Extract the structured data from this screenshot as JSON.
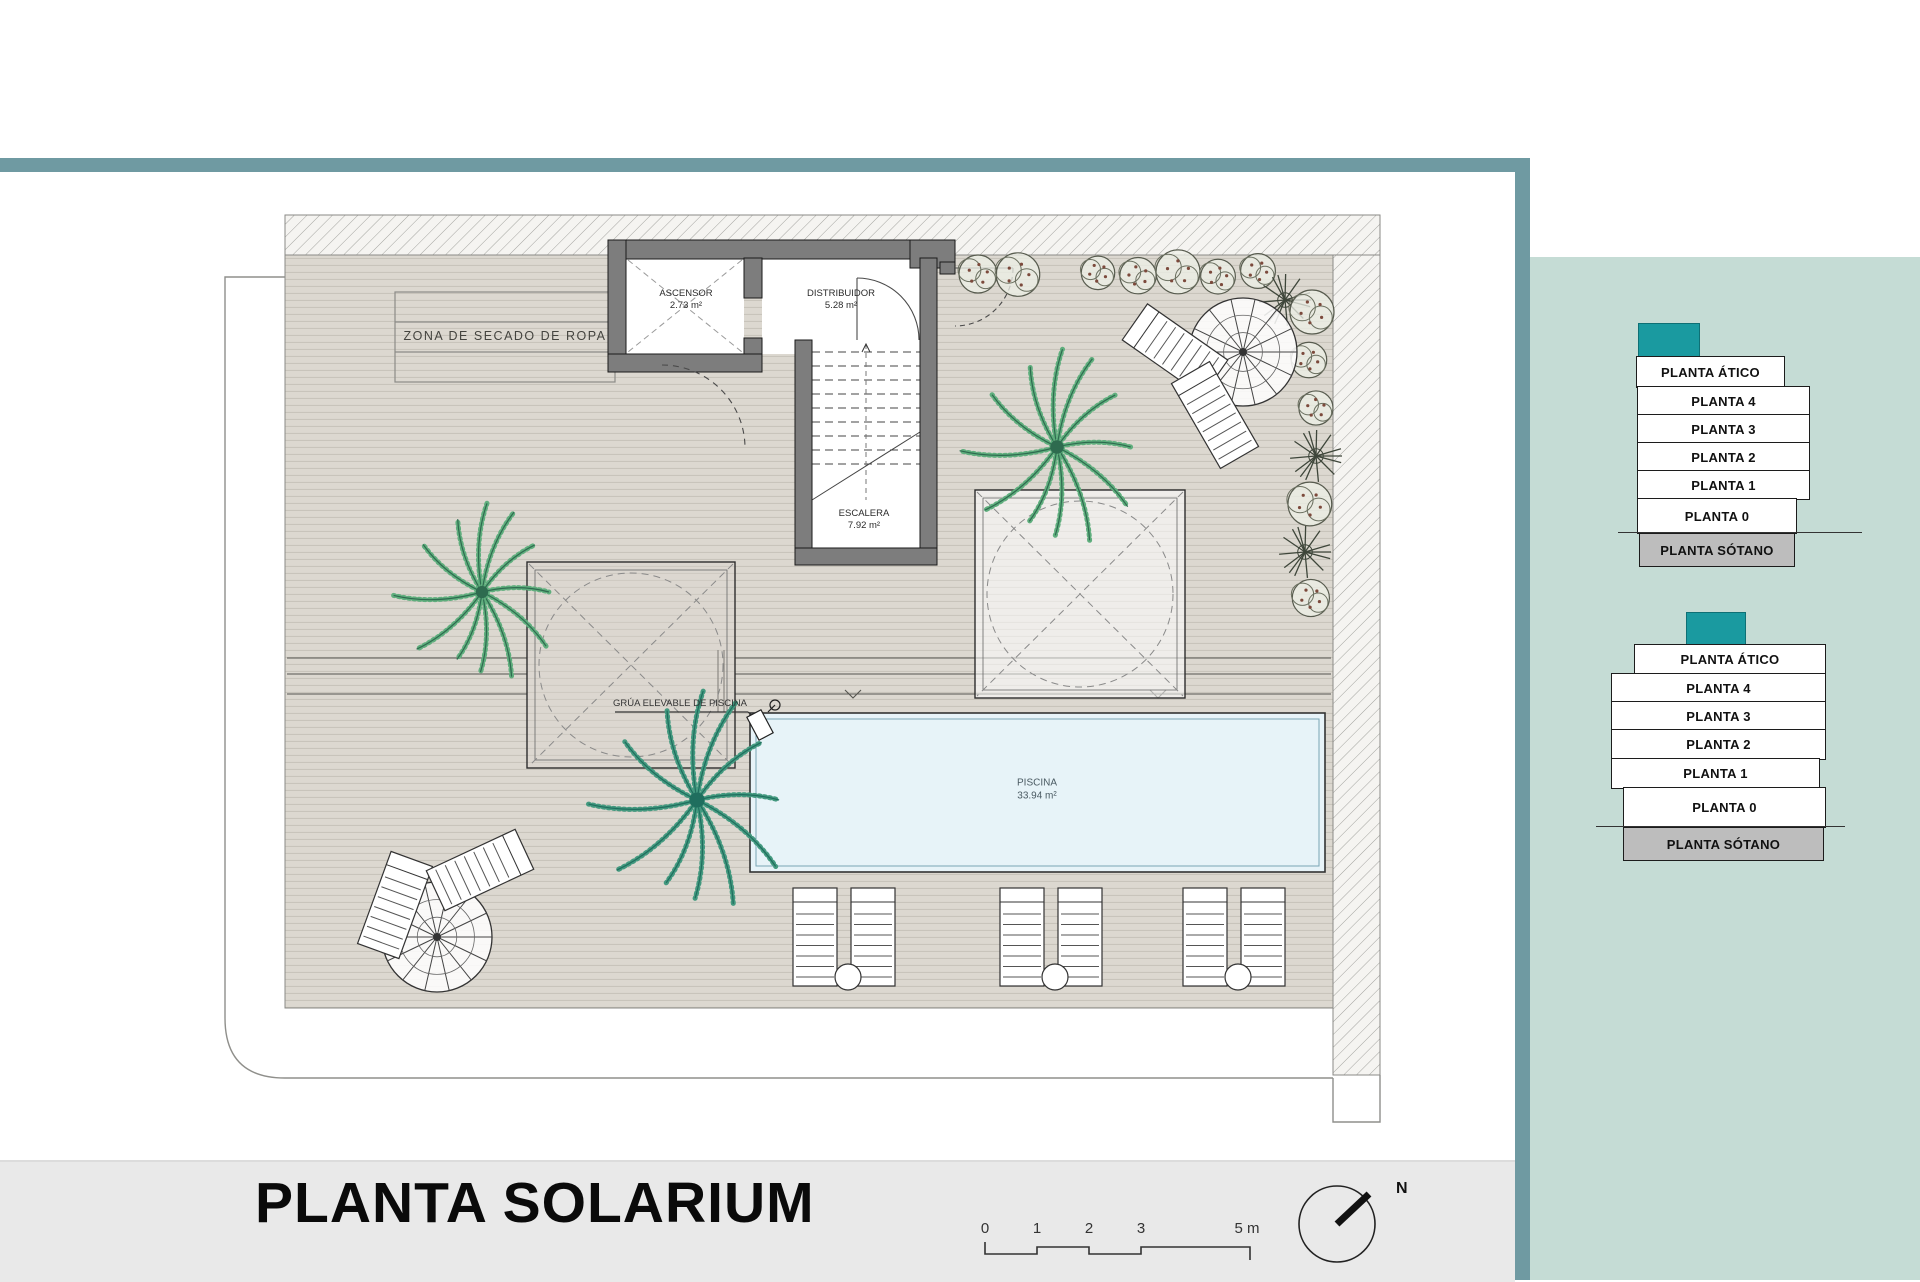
{
  "colors": {
    "accent_teal": "#1a9aa0",
    "frame_teal": "#6f9aa2",
    "sidebar_bg": "#c5dcd5",
    "footer_bg": "#e9e9e9",
    "sotano_gray": "#bdbdbd",
    "pool_fill": "#e7f3f8",
    "deck_fill": "#dcd8d0",
    "wall_fill": "#7d7d7d"
  },
  "plan": {
    "rooms": {
      "zona_secado": {
        "label": "ZONA DE SECADO DE ROPA"
      },
      "ascensor": {
        "label": "ASCENSOR",
        "area": "2.73 m²"
      },
      "distribuidor": {
        "label": "DISTRIBUIDOR",
        "area": "5.28 m²"
      },
      "escalera": {
        "label": "ESCALERA",
        "area": "7.92 m²"
      },
      "piscina": {
        "label": "PISCINA",
        "area": "33.94 m²"
      },
      "grua": {
        "label": "GRÚA ELEVABLE DE PISCINA"
      }
    }
  },
  "footer": {
    "title": "PLANTA SOLARIUM",
    "scale_ticks": [
      "0",
      "1",
      "2",
      "3",
      "5 m"
    ],
    "north_label": "N"
  },
  "sidebar": {
    "building_a": {
      "floors": [
        "PLANTA ÁTICO",
        "PLANTA 4",
        "PLANTA 3",
        "PLANTA 2",
        "PLANTA 1",
        "PLANTA 0",
        "PLANTA SÓTANO"
      ]
    },
    "building_b": {
      "floors": [
        "PLANTA ÁTICO",
        "PLANTA 4",
        "PLANTA 3",
        "PLANTA 2",
        "PLANTA 1",
        "PLANTA 0",
        "PLANTA SÓTANO"
      ]
    }
  }
}
